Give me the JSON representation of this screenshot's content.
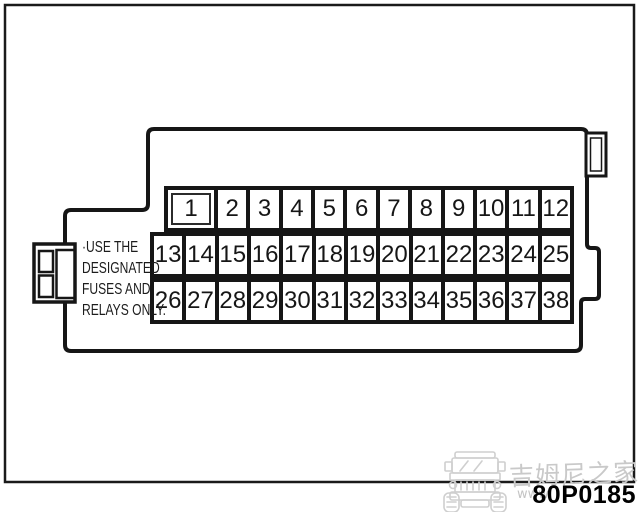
{
  "diagram": {
    "type": "fuse-box",
    "note_lines": [
      "·USE THE",
      "DESIGNATED",
      "FUSES AND",
      "RELAYS ONLY."
    ],
    "figure_code": "80P0185"
  },
  "fuse_box": {
    "rows": [
      {
        "cells": [
          "1",
          "2",
          "3",
          "4",
          "5",
          "6",
          "7",
          "8",
          "9",
          "10",
          "11",
          "12"
        ]
      },
      {
        "cells": [
          "13",
          "14",
          "15",
          "16",
          "17",
          "18",
          "19",
          "20",
          "21",
          "22",
          "23",
          "24",
          "25"
        ]
      },
      {
        "cells": [
          "26",
          "27",
          "28",
          "29",
          "30",
          "31",
          "32",
          "33",
          "34",
          "35",
          "36",
          "37",
          "38"
        ]
      }
    ]
  },
  "watermark": {
    "cn_text": "吉姆尼之家",
    "url_text": "www",
    "car_icon": "jeep-front-icon",
    "color": "#c9c9c9"
  },
  "colors": {
    "line": "#161616",
    "background": "#ffffff"
  }
}
